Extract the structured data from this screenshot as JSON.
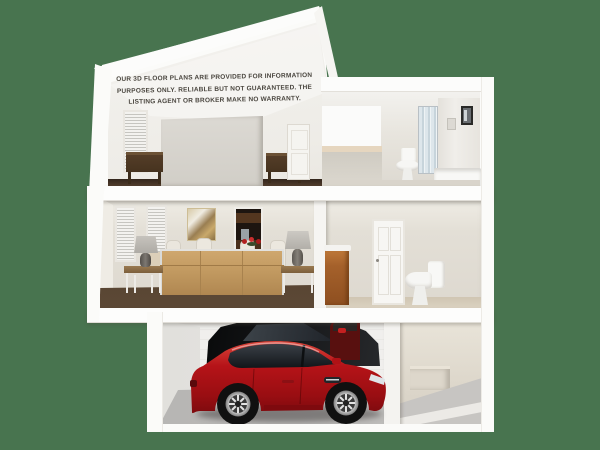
{
  "scene": {
    "type": "3d-floor-plan-cutaway",
    "disclaimer": {
      "line1": "OUR 3D FLOOR PLANS ARE PROVIDED FOR INFORMATION",
      "line2": "PURPOSES ONLY. RELIABLE BUT NOT GUARANTEED. THE",
      "line3": "LISTING AGENT OR BROKER MAKE NO WARRANTY."
    },
    "floors": [
      {
        "name": "attic",
        "rooms": [
          "bedroom",
          "bathroom"
        ]
      },
      {
        "name": "main",
        "rooms": [
          "living-room",
          "dining-area",
          "kitchen-doorway",
          "powder-room"
        ]
      },
      {
        "name": "garage-level",
        "rooms": [
          "garage",
          "entry-hallway"
        ]
      }
    ],
    "objects": [
      "bed-headboard",
      "nightstand",
      "window-blinds",
      "interior-door",
      "vanity-counter",
      "toilet",
      "shower-glass",
      "sofa",
      "table-lamp",
      "end-table",
      "dining-chairs",
      "flower-centerpiece",
      "wall-painting",
      "sink-cabinet",
      "red-sedan-car",
      "black-car",
      "maroon-car",
      "concrete-floor",
      "wood-floor"
    ],
    "palette": {
      "background": "#48744f",
      "exterior_wall": "#fbfbf9",
      "interior_wall": "#e3dfd6",
      "wood_floor": "#4a3828",
      "garage_floor": "#b7b6b3",
      "sofa_tan": "#c09a63",
      "cabinet_orange": "#a5612b",
      "red_car": "#a30f14",
      "black_car": "#101113",
      "dark_wood_furniture": "#4e3a28"
    }
  }
}
